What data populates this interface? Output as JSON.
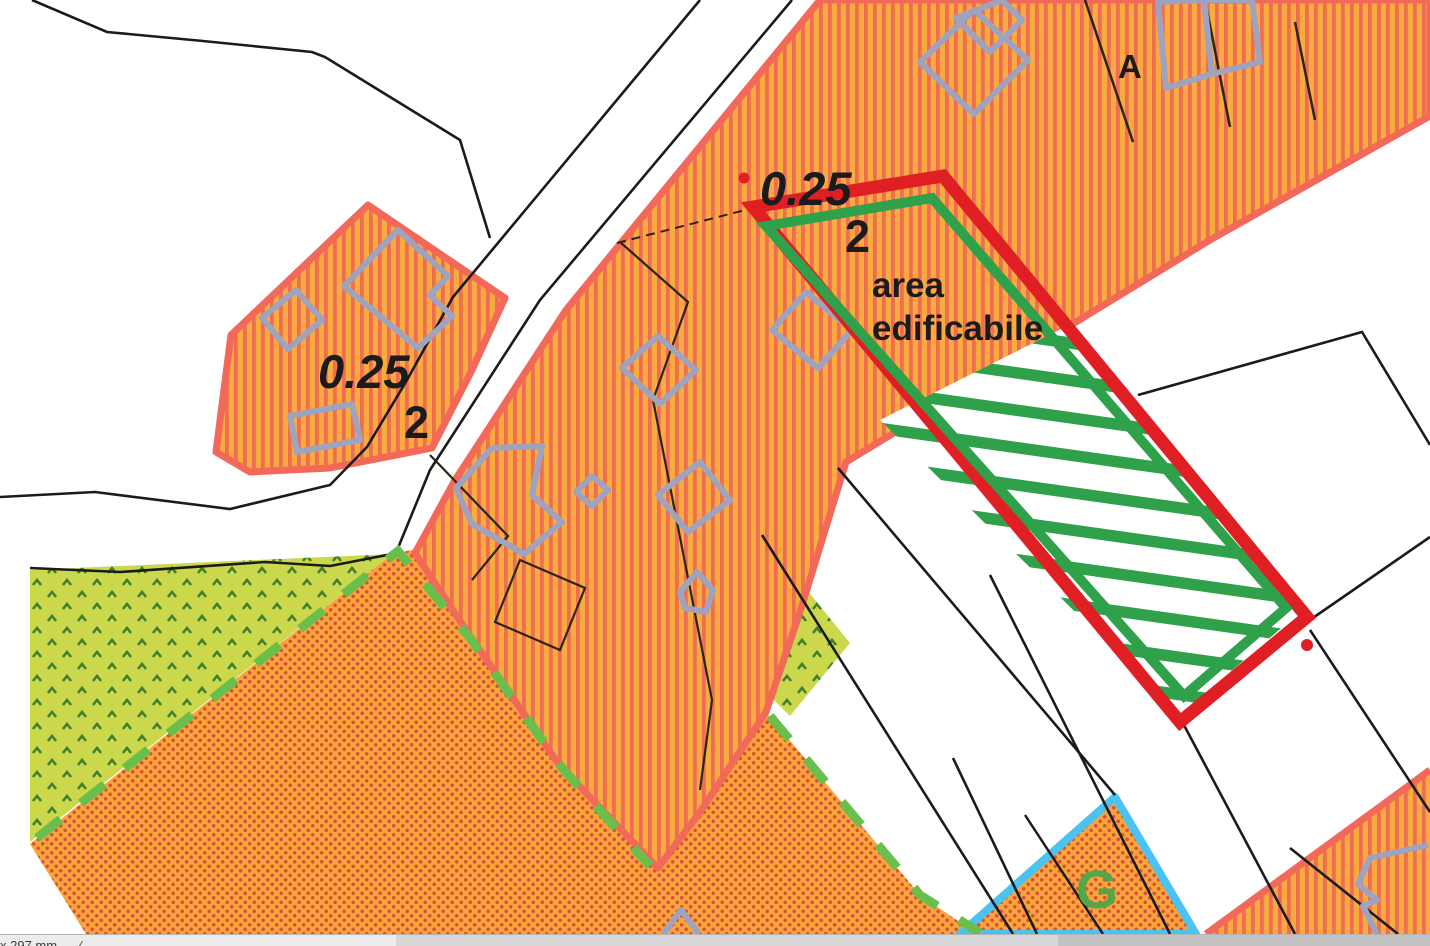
{
  "map": {
    "zone_left": {
      "index": "0.25",
      "sub_index": "2"
    },
    "zone_parcel": {
      "index": "0.25",
      "sub_index": "2"
    },
    "highlight": {
      "label_line1": "area",
      "label_line2": "edificabile"
    },
    "letters": {
      "building_letter": "A",
      "zone_letter": "G"
    },
    "colors": {
      "zone_orange": "#F9AA40",
      "zone_stripe_red": "#EF6E52",
      "zone_border_pink": "#F2695A",
      "zone_dot_red": "#D9503A",
      "green_area": "#CBD84B",
      "green_area_mark": "#3F7F2F",
      "highlight_red": "#E01F25",
      "highlight_green": "#2FA14B",
      "dashed_green": "#69BE4C",
      "blue_border": "#4BC2EF",
      "building_gray": "#9EA3BF",
      "line_black": "#1b1b1b"
    }
  },
  "status_bar": {
    "page_size_text": "x 297 mm",
    "separator": "∕"
  }
}
